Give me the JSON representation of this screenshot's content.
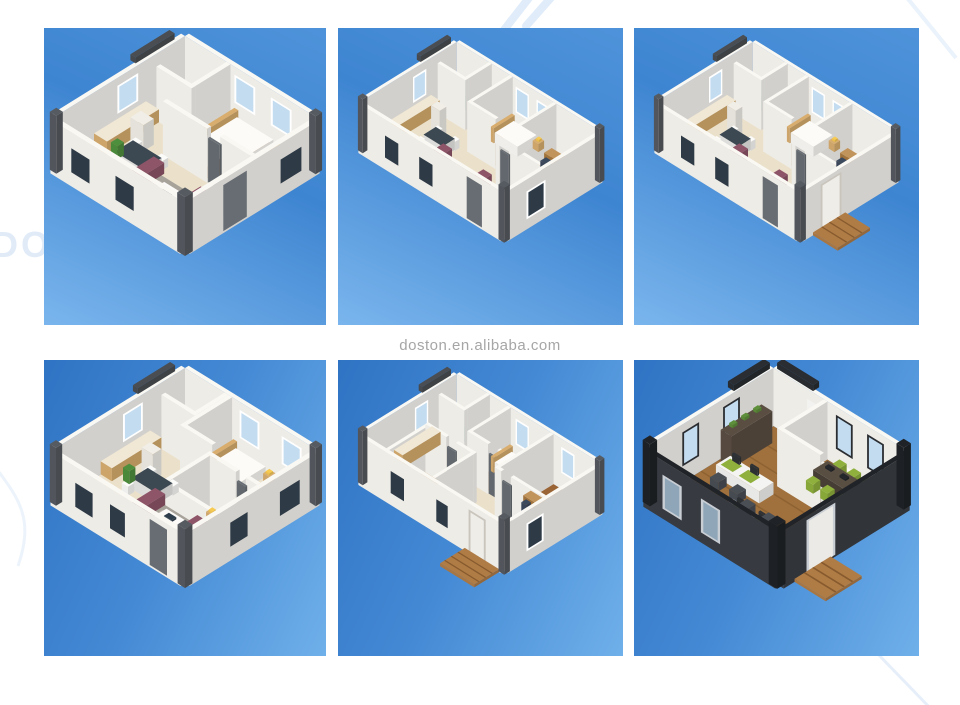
{
  "image": {
    "type": "product-image-collage",
    "subject": "Isometric 3D floor plan renders of expandable container houses",
    "rows": 2,
    "columns": 3
  },
  "watermark": {
    "center_text": "doston.en.alibaba.com",
    "partial_brand_text": "DOSTON",
    "text_color": "#a6a6a6",
    "faint_color": "#dce9f8"
  },
  "tiles": [
    {
      "id": "floorplan-1",
      "description": "3D floor plan: one-bedroom container house with bathroom (teal shower), kitchen counter, dining table, living room with maroon sofa, gray rug and white coffee table"
    },
    {
      "id": "floorplan-2",
      "description": "3D floor plan: two-bedroom container house with bathroom, kitchen counter, dining set, maroon lounge suite and desk in second bedroom"
    },
    {
      "id": "floorplan-3",
      "description": "3D floor plan: two-bedroom container house with wooden entry deck at the front door"
    },
    {
      "id": "floorplan-4",
      "description": "3D floor plan: two-bedroom container house with large open living area, dining table and maroon sofa"
    },
    {
      "id": "floorplan-5",
      "description": "3D floor plan: three-bedroom container house with study desks, wood bedroom floors and wooden entry deck"
    },
    {
      "id": "floorplan-6",
      "description": "3D floor plan: open-plan container office with green workstations, meeting room, shelving, orange chair and wooden deck"
    }
  ],
  "colors": {
    "tileBlueTop": "#4e95dc",
    "tileBlueDeep": "#3a80cd",
    "tileBlueLight": "#74b3ec",
    "wall": "#faf8f3",
    "floor": "#ebe1cb",
    "floorLight": "#f3ecdc",
    "wood": "#9a6434",
    "woodDark": "#6f441d",
    "deck": "#b07c46",
    "deckDark": "#7d5328",
    "rug": "#a7a29a",
    "rugLight": "#c2bdb5",
    "sofa": "#8e5468",
    "tableTop": "#3c4852",
    "counter": "#d8ad6e",
    "counterTop": "#f0e7d4",
    "teal": "#8fd4cc",
    "tealDeep": "#56b8ac",
    "glass": "#c3dcf0",
    "winDark": "#2e3a46",
    "door": "#676d73",
    "beam": "#4a4e52",
    "post": "#565b61",
    "oFloor": "#a0713c",
    "oFloorD": "#744e24",
    "oWall": "#3a3e44",
    "oGreen": "#8fb03c",
    "chair": "#4a4f56",
    "shelf": "#5a4d42",
    "orange": "#e8860f"
  }
}
